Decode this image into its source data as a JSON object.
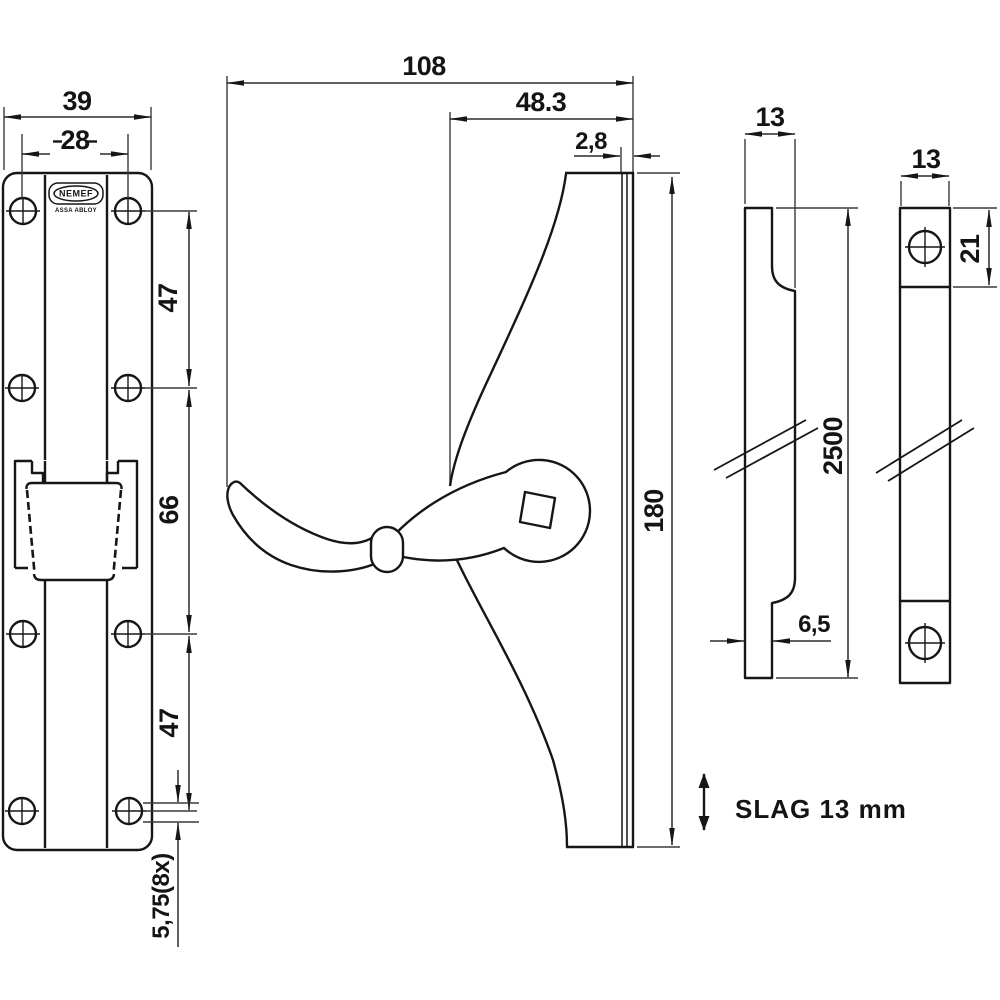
{
  "colors": {
    "background": "#ffffff",
    "line": "#161616"
  },
  "brand": {
    "logo": "NEMEF",
    "sub": "ASSA ABLOY"
  },
  "front_view": {
    "total_width": "39",
    "hole_spacing": "28",
    "seg_top": "47",
    "seg_mid": "66",
    "seg_bot": "47",
    "hole_note": "5,75(8x)"
  },
  "side_view": {
    "depth": "108",
    "handle_offset": "48.3",
    "plate_thickness": "2,8",
    "height": "180"
  },
  "profile_view": {
    "width": "13",
    "length": "2500",
    "step": "6,5"
  },
  "face_view": {
    "width": "13",
    "end_height": "21"
  },
  "note": {
    "stroke_text": "SLAG 13 mm"
  }
}
